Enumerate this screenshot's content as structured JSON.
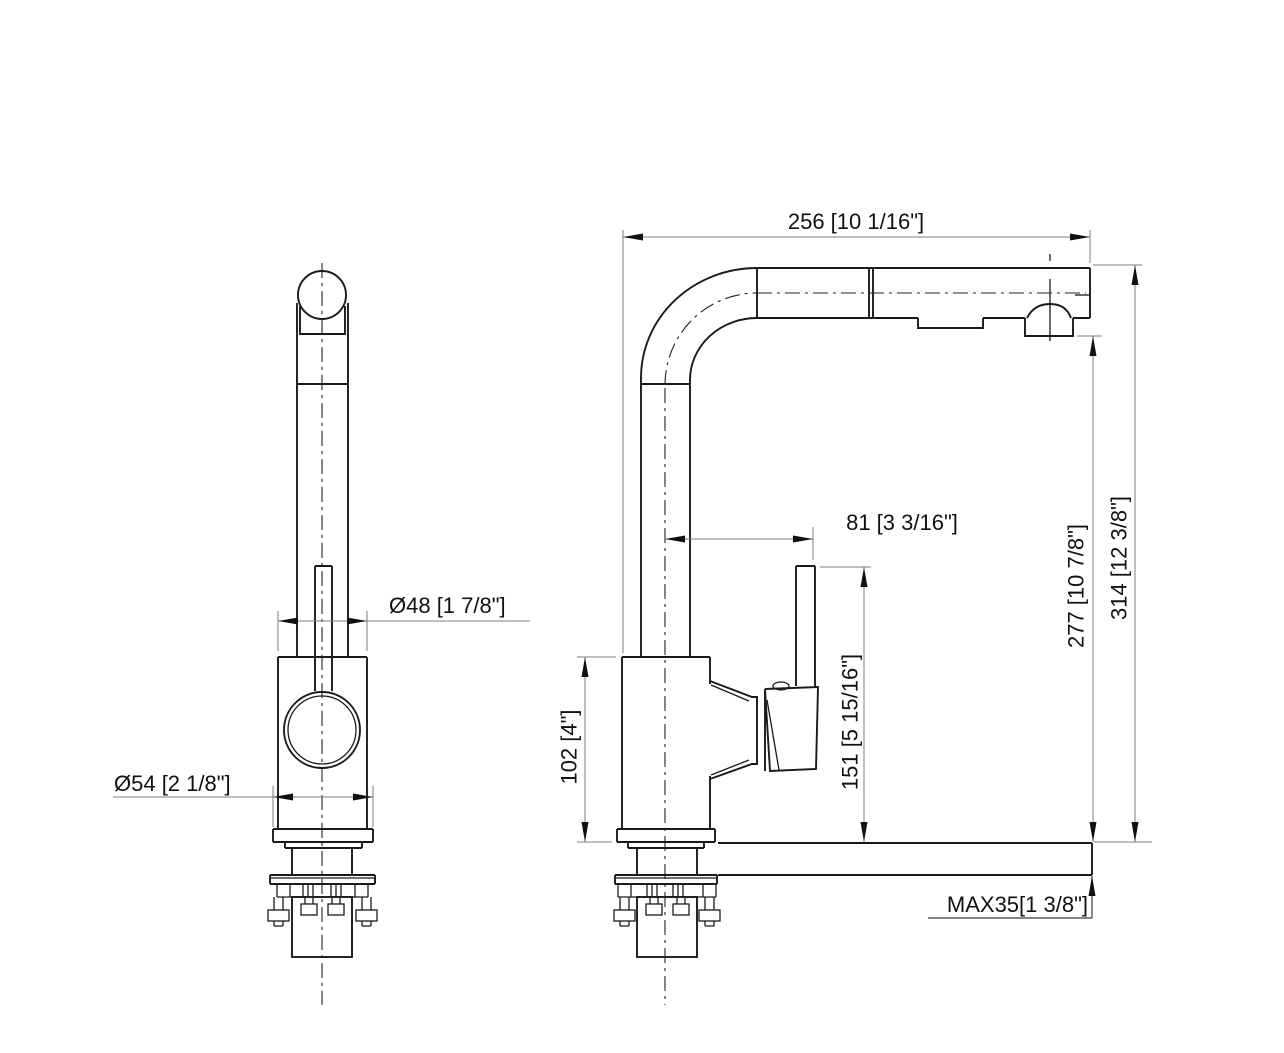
{
  "drawing": {
    "type": "faucet-installation-dimension-drawing",
    "views": {
      "front_view": "front elevation of pull-out kitchen faucet",
      "side_view": "side elevation of pull-out kitchen faucet with counter deck"
    },
    "line_colors": {
      "object": "#1a1a1a",
      "dimension": "#7d7d7d",
      "centerline": "#222222"
    }
  },
  "dimensions": {
    "spout_reach": "256 [10 1/16\"]",
    "body_diameter": "Ø48 [1 7/8\"]",
    "base_diameter": "Ø54 [2 1/8\"]",
    "handle_offset": "81 [3 3/16\"]",
    "body_height": "102 [4\"]",
    "handle_height": "151 [5 15/16\"]",
    "spout_outlet_height": "277 [10 7/8\"]",
    "overall_height": "314 [12 3/8\"]",
    "max_deck_thickness": "MAX35[1 3/8\"]"
  }
}
